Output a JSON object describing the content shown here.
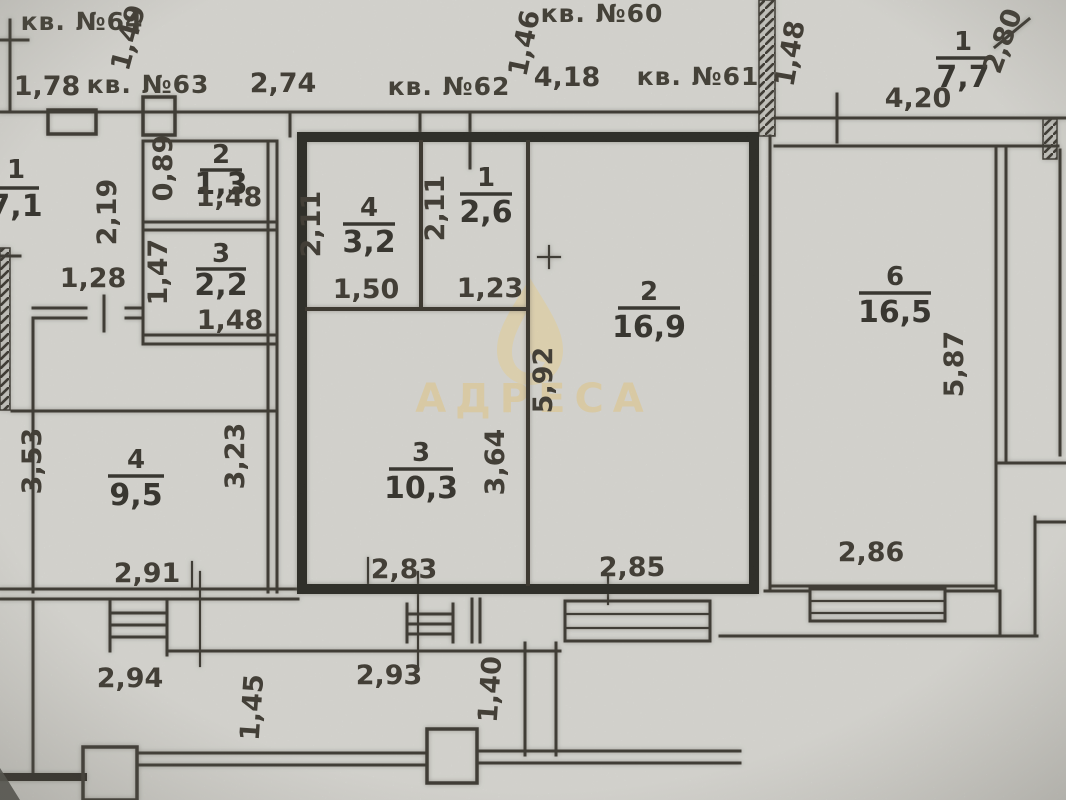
{
  "watermark": {
    "text": "АДРЕСА"
  },
  "apartment_labels": [
    {
      "text": "кв. №64",
      "x": 82,
      "y": 30
    },
    {
      "text": "кв. №63",
      "x": 148,
      "y": 93
    },
    {
      "text": "кв. №62",
      "x": 449,
      "y": 95
    },
    {
      "text": "кв. №60",
      "x": 602,
      "y": 22
    },
    {
      "text": "кв. №61",
      "x": 698,
      "y": 85
    }
  ],
  "rooms": [
    {
      "number": "1",
      "area": "7,1",
      "x": 16,
      "ny": 178,
      "ly": 188,
      "ay": 216,
      "lw": 46
    },
    {
      "number": "2",
      "area": "1,3",
      "x": 221,
      "ny": 163,
      "ly": 170,
      "ay": 194,
      "lw": 42
    },
    {
      "number": "3",
      "area": "2,2",
      "x": 221,
      "ny": 262,
      "ly": 269,
      "ay": 295,
      "lw": 50
    },
    {
      "number": "4",
      "area": "3,2",
      "x": 369,
      "ny": 216,
      "ly": 224,
      "ay": 252,
      "lw": 52
    },
    {
      "number": "1",
      "area": "2,6",
      "x": 486,
      "ny": 186,
      "ly": 194,
      "ay": 222,
      "lw": 52
    },
    {
      "number": "2",
      "area": "16,9",
      "x": 649,
      "ny": 300,
      "ly": 308,
      "ay": 337,
      "lw": 62
    },
    {
      "number": "3",
      "area": "10,3",
      "x": 421,
      "ny": 461,
      "ly": 469,
      "ay": 498,
      "lw": 64
    },
    {
      "number": "4",
      "area": "9,5",
      "x": 136,
      "ny": 468,
      "ly": 476,
      "ay": 505,
      "lw": 56
    },
    {
      "number": "6",
      "area": "16,5",
      "x": 895,
      "ny": 285,
      "ly": 293,
      "ay": 322,
      "lw": 72
    },
    {
      "number": "1",
      "area": "7,7",
      "x": 963,
      "ny": 50,
      "ly": 58,
      "ay": 87,
      "lw": 54
    }
  ],
  "dimensions": [
    {
      "text": "1,49",
      "x": 137,
      "y": 40,
      "rot": -75
    },
    {
      "text": "1,78",
      "x": 47,
      "y": 95
    },
    {
      "text": "2,74",
      "x": 283,
      "y": 92
    },
    {
      "text": "1,46",
      "x": 533,
      "y": 45,
      "rot": -78
    },
    {
      "text": "4,18",
      "x": 567,
      "y": 86
    },
    {
      "text": "1,48",
      "x": 799,
      "y": 55,
      "rot": -80
    },
    {
      "text": "4,20",
      "x": 918,
      "y": 107
    },
    {
      "text": "2,80",
      "x": 1011,
      "y": 44,
      "rot": -70
    },
    {
      "text": "2,19",
      "x": 116,
      "y": 212,
      "rot": -90
    },
    {
      "text": "0,89",
      "x": 172,
      "y": 168,
      "rot": -90
    },
    {
      "text": "1,48",
      "x": 229,
      "y": 206
    },
    {
      "text": "1,47",
      "x": 167,
      "y": 272,
      "rot": -90
    },
    {
      "text": "1,48",
      "x": 230,
      "y": 329
    },
    {
      "text": "1,28",
      "x": 93,
      "y": 287
    },
    {
      "text": "2,11",
      "x": 320,
      "y": 224,
      "rot": -90
    },
    {
      "text": "1,50",
      "x": 366,
      "y": 298
    },
    {
      "text": "2,11",
      "x": 444,
      "y": 208,
      "rot": -90
    },
    {
      "text": "1,23",
      "x": 490,
      "y": 297
    },
    {
      "text": "5,92",
      "x": 552,
      "y": 380,
      "rot": -90
    },
    {
      "text": "3,64",
      "x": 504,
      "y": 462,
      "rot": -90
    },
    {
      "text": "2,83",
      "x": 404,
      "y": 578
    },
    {
      "text": "2,85",
      "x": 632,
      "y": 576
    },
    {
      "text": "3,53",
      "x": 41,
      "y": 461,
      "rot": -90
    },
    {
      "text": "3,23",
      "x": 244,
      "y": 456,
      "rot": -90
    },
    {
      "text": "2,91",
      "x": 147,
      "y": 582
    },
    {
      "text": "5,87",
      "x": 963,
      "y": 364,
      "rot": -90
    },
    {
      "text": "2,86",
      "x": 871,
      "y": 561
    },
    {
      "text": "2,94",
      "x": 130,
      "y": 687
    },
    {
      "text": "1,45",
      "x": 261,
      "y": 708,
      "rot": -86
    },
    {
      "text": "2,93",
      "x": 389,
      "y": 684
    },
    {
      "text": "1,40",
      "x": 499,
      "y": 690,
      "rot": -86
    }
  ]
}
